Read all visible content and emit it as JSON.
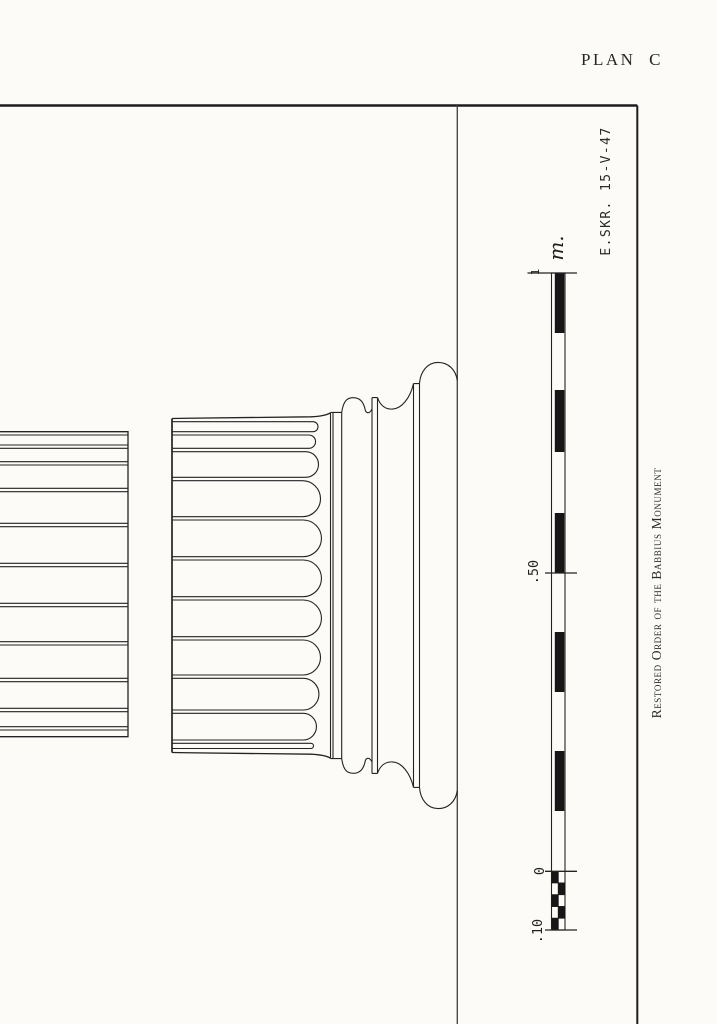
{
  "plate": {
    "label": "PLAN C",
    "paper_color": "#fcfbf8",
    "ink_color": "#232323"
  },
  "signature": "E.SKR. 15-V-47",
  "caption": "Restored Order of the Babbius Monument",
  "scale": {
    "unit": "m.",
    "marks": {
      "one": "1",
      "fifty": ".50",
      "zero": "0",
      "ten": ".10"
    }
  }
}
